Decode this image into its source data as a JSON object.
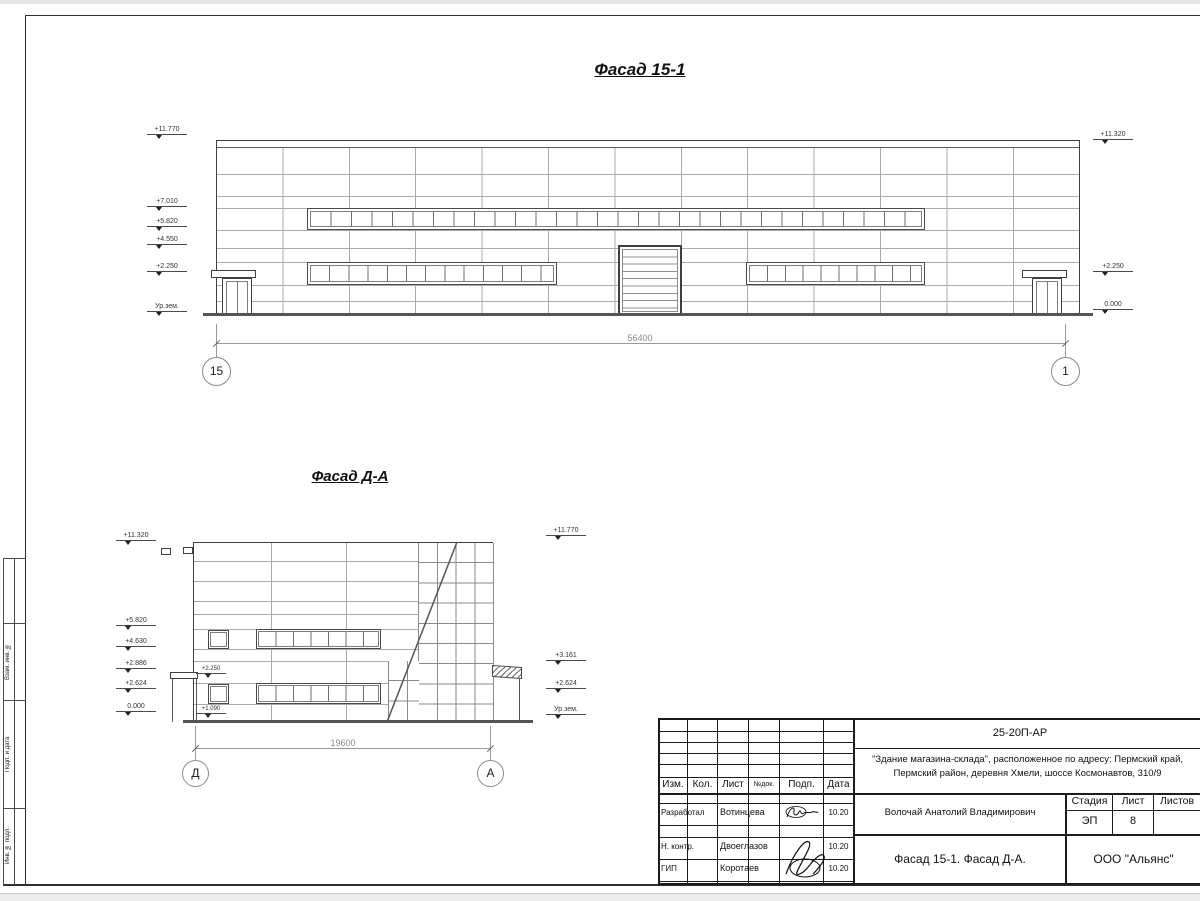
{
  "sheet": {
    "side_stamp": {
      "labels": [
        "Взам. инв. №",
        "Подп. и дата",
        "Инв. № подл."
      ]
    },
    "facade1": {
      "title": "Фасад 15-1",
      "marks_left": [
        "+11.770",
        "+7.010",
        "+5.820",
        "+4.550",
        "+2.250",
        "Ур.зем."
      ],
      "marks_right": [
        "+11.320",
        "+2.250",
        "0.000"
      ],
      "dimension": "56400",
      "axis_left": "15",
      "axis_right": "1"
    },
    "facade2": {
      "title": "Фасад Д-А",
      "marks_left": [
        "+11.320",
        "+5.820",
        "+4.630",
        "+2.886",
        "+2.624",
        "0.000"
      ],
      "marks_inner": [
        "+2.250",
        "+1.090"
      ],
      "marks_right": [
        "+11.770",
        "+3.161",
        "+2.624",
        "Ур.зем."
      ],
      "dimension": "19600",
      "axis_left": "Д",
      "axis_right": "А"
    },
    "titleblock": {
      "doc_code": "25-20П-АР",
      "project_line1": "\"Здание магазина-склада\", расположенное по адресу: Пермский край,",
      "project_line2": "Пермский район, деревня Хмели, шоссе Космонавтов, 310/9",
      "columns": {
        "izm": "Изм.",
        "kol": "Кол.",
        "list": "Лист",
        "ndoc": "№док.",
        "podp": "Подп.",
        "data": "Дата"
      },
      "rows": [
        {
          "role": "Разработал",
          "name": "Вотинцева",
          "date": "10.20"
        },
        {
          "role": "Н. контр.",
          "name": "Двоеглазов",
          "date": "10.20"
        },
        {
          "role": "ГИП",
          "name": "Коротаев",
          "date": "10.20"
        }
      ],
      "person": "Волочай Анатолий Владимирович",
      "stage_label": "Стадия",
      "sheet_label": "Лист",
      "sheets_label": "Листов",
      "stage": "ЭП",
      "sheet_no": "8",
      "drawing_title": "Фасад 15-1. Фасад Д-А.",
      "company": "ООО \"Альянс\""
    }
  }
}
